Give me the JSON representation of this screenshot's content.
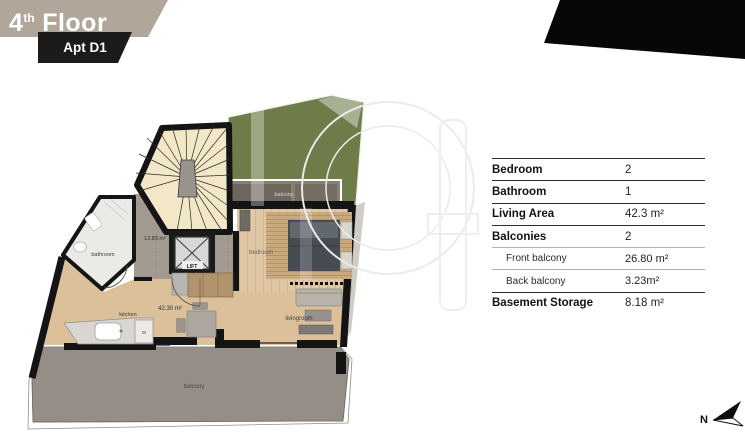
{
  "header": {
    "floor_number": "4",
    "floor_ordinal": "th",
    "floor_word": "Floor",
    "apartment_label": "Apt D1"
  },
  "specs": {
    "rows": [
      {
        "label": "Bedroom",
        "value": "2"
      },
      {
        "label": "Bathroom",
        "value": "1"
      },
      {
        "label": "Living Area",
        "value": "42.3 m²"
      },
      {
        "label": "Balconies",
        "value": "2"
      },
      {
        "label": "Front balcony",
        "value": "26.80 m²"
      },
      {
        "label": "Back balcony",
        "value": "3.23m²"
      },
      {
        "label": "Basement Storage",
        "value": "8.18 m²"
      }
    ]
  },
  "plan": {
    "labels": {
      "bathroom": "bathroom",
      "kitchen": "kitchen",
      "livingroom": "livingroom",
      "bedroom": "bedroom",
      "lift": "LIFT",
      "back_balcony": "balcony",
      "front_balcony": "balcony",
      "hall_area": "13.83 m²",
      "living_area": "42.30 m²",
      "washer": "w"
    }
  },
  "compass": {
    "north_label": "N"
  },
  "colors": {
    "banner_tan": "#b1a69a",
    "badge_black": "#1c1b19",
    "garden_green": "#6d7c49",
    "stair_cream": "#f2e7c7",
    "wood_floor": "#dcc09a",
    "balcony_gray": "#958e86",
    "wall_black": "#141414"
  }
}
